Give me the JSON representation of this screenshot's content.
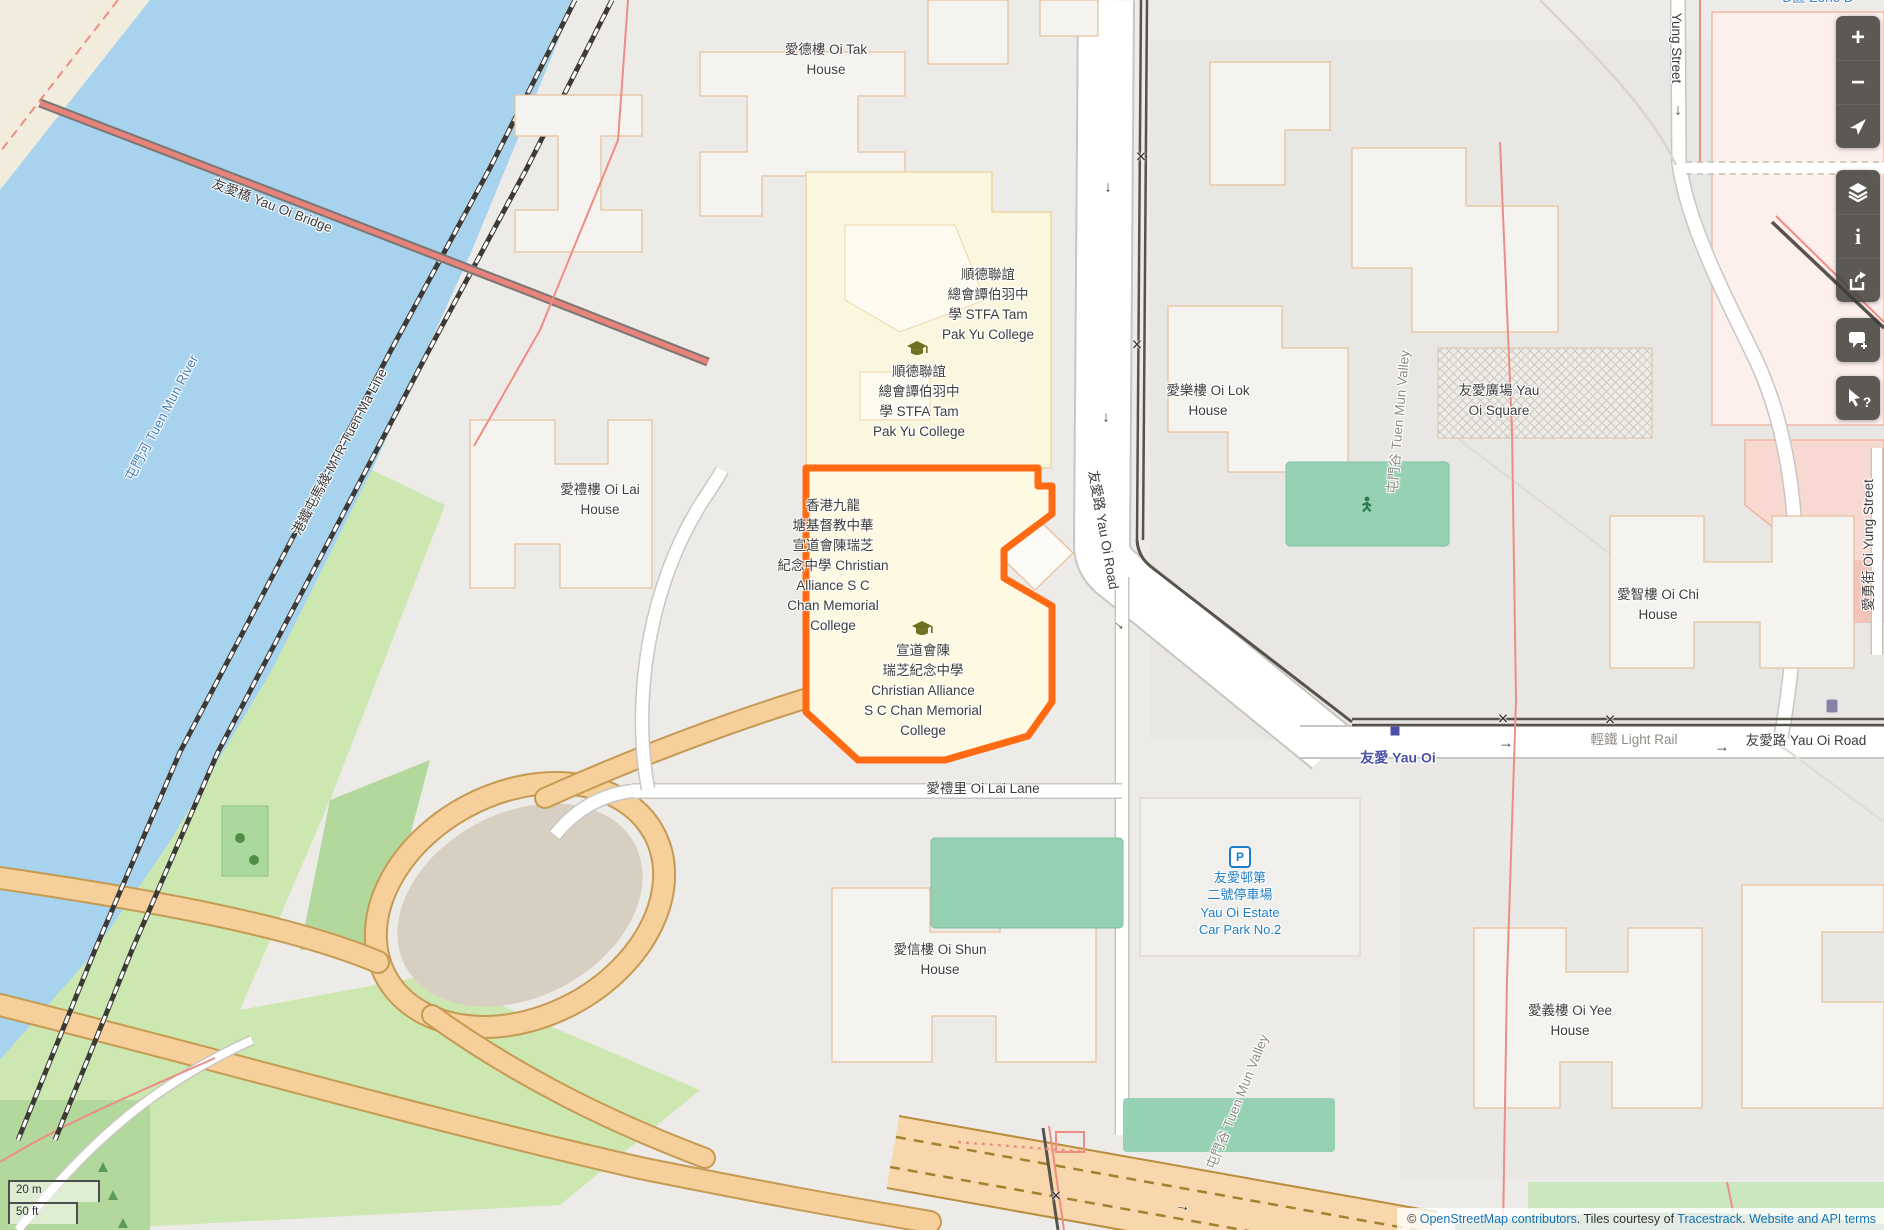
{
  "labels": {
    "oi_tak": {
      "text": "愛德樓 Oi Tak\nHouse"
    },
    "stfa_upper": {
      "text": "順德聯誼\n總會譚伯羽中\n學 STFA Tam\nPak Yu College"
    },
    "stfa_lower": {
      "text": "順德聯誼\n總會譚伯羽中\n學 STFA Tam\nPak Yu College"
    },
    "ca_long": {
      "text": "香港九龍\n塘基督教中華\n宣道會陳瑞芝\n紀念中學 Christian\nAlliance S C\nChan Memorial\nCollege"
    },
    "ca_short": {
      "text": "宣道會陳\n瑞芝紀念中學\nChristian Alliance\nS C Chan Memorial\nCollege"
    },
    "oi_lai_house": {
      "text": "愛禮樓 Oi Lai\nHouse"
    },
    "oi_lok": {
      "text": "愛樂樓 Oi Lok\nHouse"
    },
    "yau_oi_square": {
      "text": "友愛廣場 Yau\nOi Square"
    },
    "oi_chi": {
      "text": "愛智樓 Oi Chi\nHouse"
    },
    "oi_yee": {
      "text": "愛義樓 Oi Yee\nHouse"
    },
    "oi_shun": {
      "text": "愛信樓 Oi Shun\nHouse"
    },
    "oi_lai_lane": {
      "text": "愛禮里 Oi Lai Lane"
    },
    "yau_oi_rd_v": {
      "text": "友愛路 Yau Oi Road"
    },
    "yau_oi_rd_h": {
      "text": "友愛路 Yau Oi Road"
    },
    "light_rail": {
      "text": "輕鐵 Light Rail"
    },
    "station": {
      "text": "友愛 Yau Oi"
    },
    "car_park": {
      "text": "友愛邨第\n二號停車場\nYau Oi Estate\nCar Park No.2"
    },
    "zone_d": {
      "text": "D區 Zone D"
    },
    "bridge": {
      "text": "友愛橋 Yau Oi Bridge"
    },
    "mtr": {
      "text": "港鐵屯馬綫 MTR Tuen Ma Line"
    },
    "river": {
      "text": "屯門河 Tuen Mun River"
    },
    "tmv1": {
      "text": "屯門谷 Tuen Mun Valley"
    },
    "tmv2": {
      "text": "屯門谷 Tuen Mun Valley"
    },
    "oi_yung_v": {
      "text": "愛勇街 Oi Yung Street"
    },
    "yung_street": {
      "text": "Yung Street"
    }
  },
  "symbols": {
    "down": "↓",
    "right": "→",
    "cross": "×",
    "p": "P"
  },
  "controls": {
    "zoom_in": "+",
    "zoom_out": "−",
    "info": "i",
    "query": "?"
  },
  "scale": {
    "metric": "20 m",
    "imperial": "50 ft"
  },
  "attribution": {
    "prefix": "© ",
    "osm_link": "OpenStreetMap contributors",
    "courtesy": ". Tiles courtesy of ",
    "tracestrack_link": "Tracestrack",
    "sep": ". ",
    "terms_link": "Website and API terms"
  },
  "colors": {
    "highlight": "#ff6a13",
    "water": "#a8d3ee",
    "school_fill": "#fdf9e2",
    "station_blue": "#4b50a7",
    "amenity_blue": "#1f7ec7",
    "link_blue": "#1673b8",
    "pitch_green": "#97d1b4",
    "highway_peach": "#f6cf9b"
  }
}
